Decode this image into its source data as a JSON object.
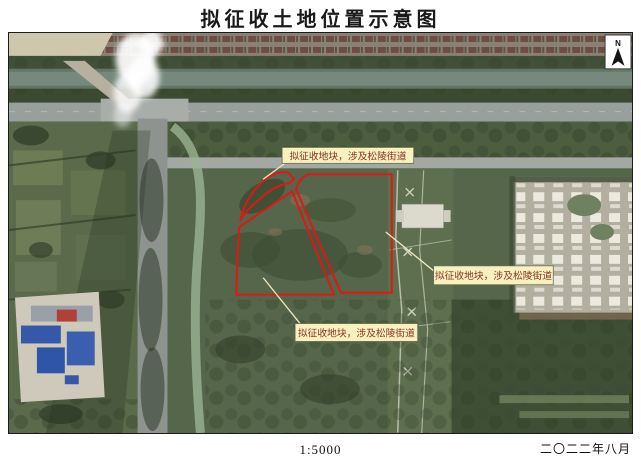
{
  "page_title": "拟征收土地位置示意图",
  "map": {
    "north_indicator": "N",
    "parcel_labels": [
      {
        "text": "拟征收地块，涉及松陵街道"
      },
      {
        "text": "拟征收地块，涉及松陵街道"
      },
      {
        "text": "拟征收地块，涉及松陵街道"
      }
    ],
    "colors": {
      "parcel_outline": "#e31515",
      "label_background": "#f6f1bd",
      "label_border": "#6b6b58",
      "label_text": "#8a3226"
    }
  },
  "footer": {
    "scale": "1:5000",
    "date": "二〇二二年八月"
  }
}
